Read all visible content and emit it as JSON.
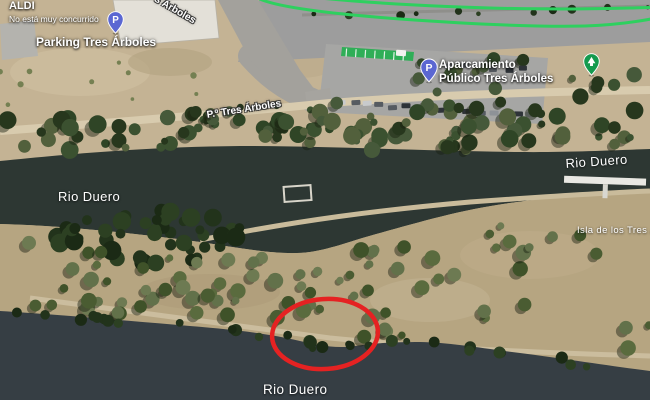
{
  "app": {
    "view": "satellite-map"
  },
  "map": {
    "labels": {
      "aldi_title": "ALDI",
      "aldi_subtitle": "No está muy concurrido",
      "parking_lot": "Parking Tres Árboles",
      "road_top_partial": "s Árboles",
      "paseo_road": "P.º Tres Árboles",
      "public_parking_line1": "Aparcamiento",
      "public_parking_line2": "Público Tres Árboles",
      "river_left": "Rio Duero",
      "river_right": "Rio Duero",
      "river_bottom": "Rio Duero",
      "island": "Isla de los Tres Árboles"
    },
    "icons": {
      "parking_pin_letter": "P",
      "public_parking_pin_letter": "P"
    },
    "colors": {
      "route_green": "#2ed05f",
      "parking_pin_blue": "#5b67d2",
      "park_pin_green": "#149a4e",
      "highlight_red": "#e52222",
      "water_top": "#2d3733",
      "water_bottom": "#363e44"
    }
  }
}
